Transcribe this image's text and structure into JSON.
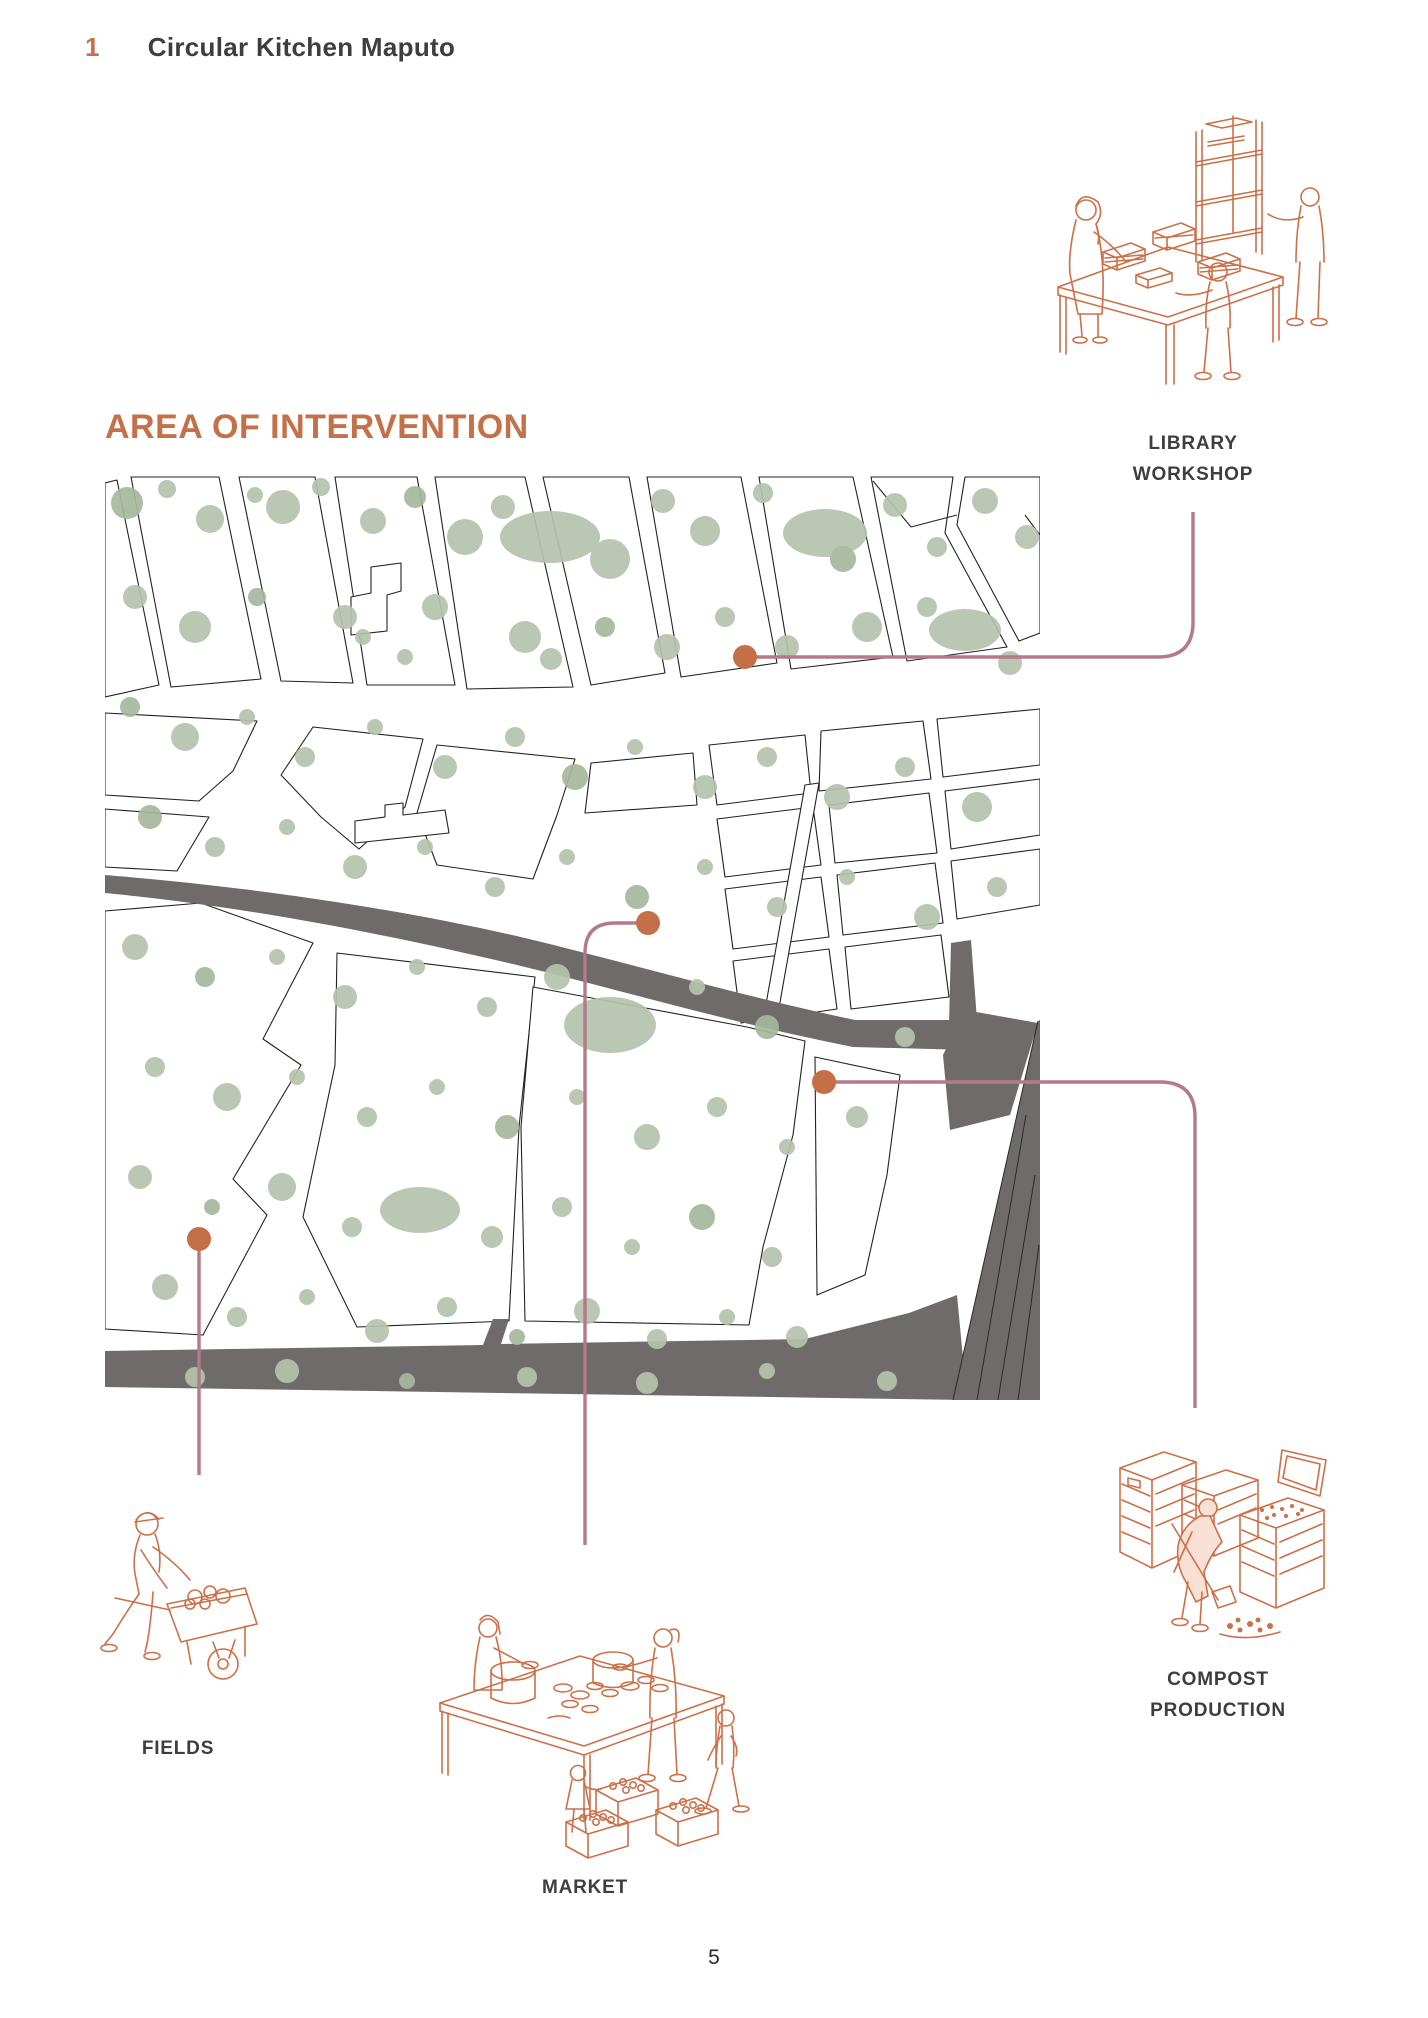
{
  "page": {
    "chapter_number": "1",
    "chapter_title": "Circular Kitchen Maputo",
    "section_title": "AREA OF INTERVENTION",
    "page_number": "5"
  },
  "callouts": {
    "library_workshop": {
      "line1": "LIBRARY",
      "line2": "WORKSHOP"
    },
    "market": {
      "label": "MARKET"
    },
    "fields": {
      "label": "FIELDS"
    },
    "compost_production": {
      "line1": "COMPOST",
      "line2": "PRODUCTION"
    }
  },
  "colors": {
    "accent_orange": "#c4714a",
    "illustration_orange": "#cb7048",
    "callout_line_rose": "#b5798a",
    "callout_dot_orange": "#c56f48",
    "map_vegetation_green": "#b5c3ac",
    "road_gray": "#6f6b6b",
    "parcel_line_black": "#222222",
    "text_dark": "#3e3e3e"
  }
}
